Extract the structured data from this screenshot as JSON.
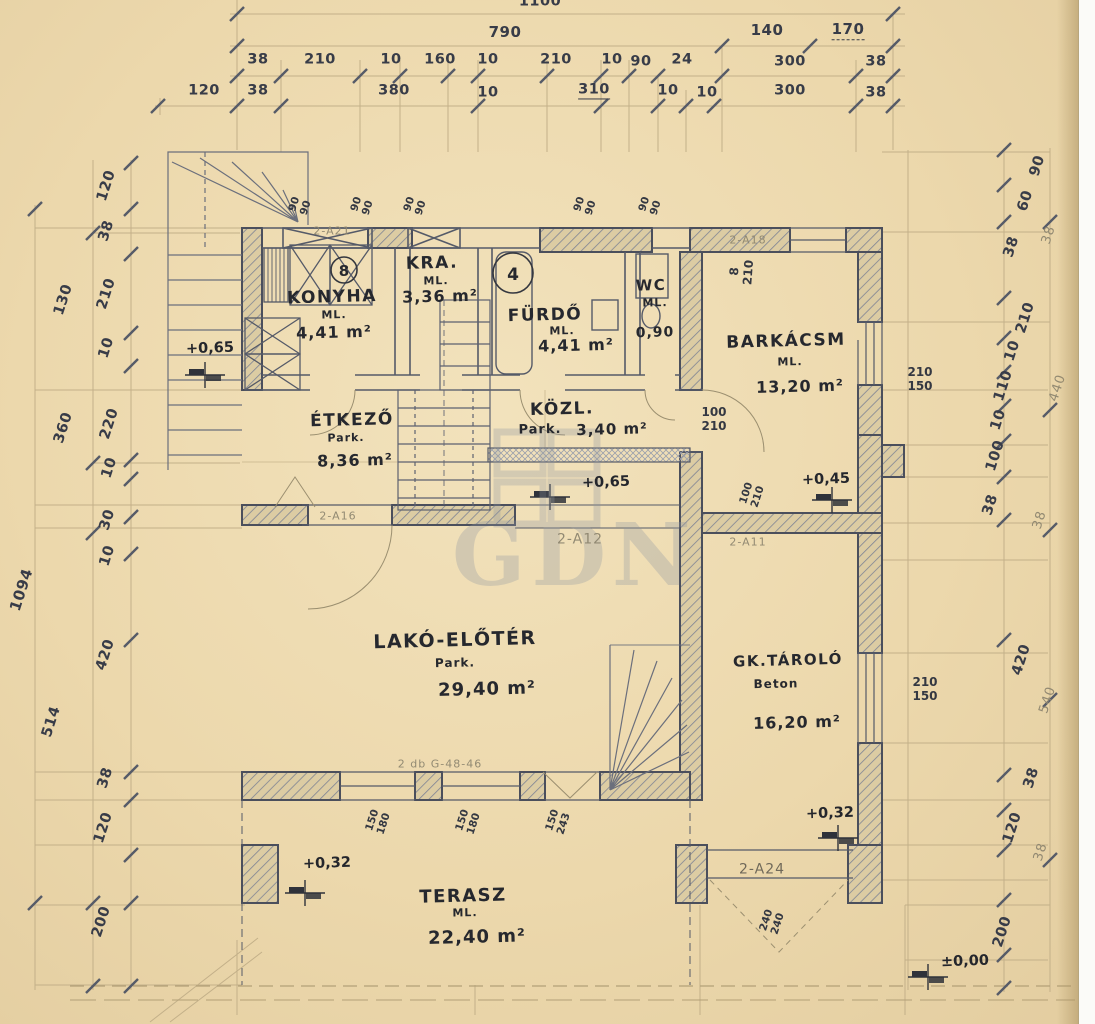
{
  "watermark": {
    "text": "GDN"
  },
  "rooms": [
    {
      "name": "KONYHA",
      "note": "ML.",
      "area": "4,41 m²"
    },
    {
      "name": "KRA.",
      "note": "ML.",
      "area": "3,36 m²"
    },
    {
      "name": "FÜRDŐ",
      "note": "ML.",
      "area": "4,41 m²"
    },
    {
      "name": "WC",
      "note": "ML.",
      "area": "0,90"
    },
    {
      "name": "BARKÁCSM",
      "note": "ML.",
      "area": "13,20 m²"
    },
    {
      "name": "ÉTKEZŐ",
      "note": "Park.",
      "area": "8,36 m²"
    },
    {
      "name": "KÖZL.",
      "note": "Park.",
      "area": "3,40 m²"
    },
    {
      "name": "LAKÓ-ELŐTÉR",
      "note": "Park.",
      "area": "29,40 m²"
    },
    {
      "name": "GK.TÁROLÓ",
      "note": "Beton",
      "area": "16,20 m²"
    },
    {
      "name": "TERASZ",
      "note": "ML.",
      "area": "22,40 m²"
    }
  ],
  "dims": {
    "top": {
      "row1": [
        "1100"
      ],
      "row2": [
        "790",
        "140",
        "170"
      ],
      "row3": [
        "38",
        "210",
        "10",
        "160",
        "10",
        "210",
        "10",
        "90",
        "24",
        "300",
        "38"
      ],
      "row4": [
        "120",
        "38",
        "380",
        "10",
        "310",
        "10",
        "10",
        "300",
        "38"
      ]
    },
    "left": {
      "outer": [
        "1094"
      ],
      "mid": [
        "130",
        "360",
        "514"
      ],
      "inner": [
        "120",
        "38",
        "210",
        "10",
        "220",
        "10",
        "30",
        "10",
        "420",
        "38",
        "120",
        "200"
      ]
    },
    "right": {
      "inner": [
        "90",
        "60",
        "38",
        "210",
        "10",
        "110",
        "10",
        "100",
        "38",
        "420",
        "38",
        "120",
        "200"
      ],
      "outer": [
        "38",
        "440",
        "38",
        "540",
        "38"
      ]
    }
  },
  "elevations": [
    "+0,65",
    "+0,65",
    "+0,45",
    "+0,32",
    "+0,32",
    "±0,00"
  ],
  "openings": [
    {
      "w": "90",
      "h": "90"
    },
    {
      "w": "90",
      "h": "90"
    },
    {
      "w": "90",
      "h": "90"
    },
    {
      "w": "90",
      "h": "90"
    },
    {
      "w": "90",
      "h": "90"
    },
    {
      "w": "100",
      "h": "210"
    },
    {
      "w": "8",
      "h": "210"
    },
    {
      "w": "210",
      "h": "150"
    },
    {
      "w": "210",
      "h": "150"
    },
    {
      "w": "150",
      "h": "180"
    },
    {
      "w": "150",
      "h": "180"
    },
    {
      "w": "150",
      "h": "243"
    },
    {
      "w": "240",
      "h": "240"
    },
    {
      "w": "100",
      "h": "210"
    }
  ],
  "pencil_labels": [
    "2-A21",
    "2-A18",
    "2-A12",
    "2-A11",
    "2-A16",
    "2-A24",
    "2 db  G-48-46"
  ],
  "symbols": {
    "kitchen_circle": "8",
    "bath_circle": "4"
  }
}
